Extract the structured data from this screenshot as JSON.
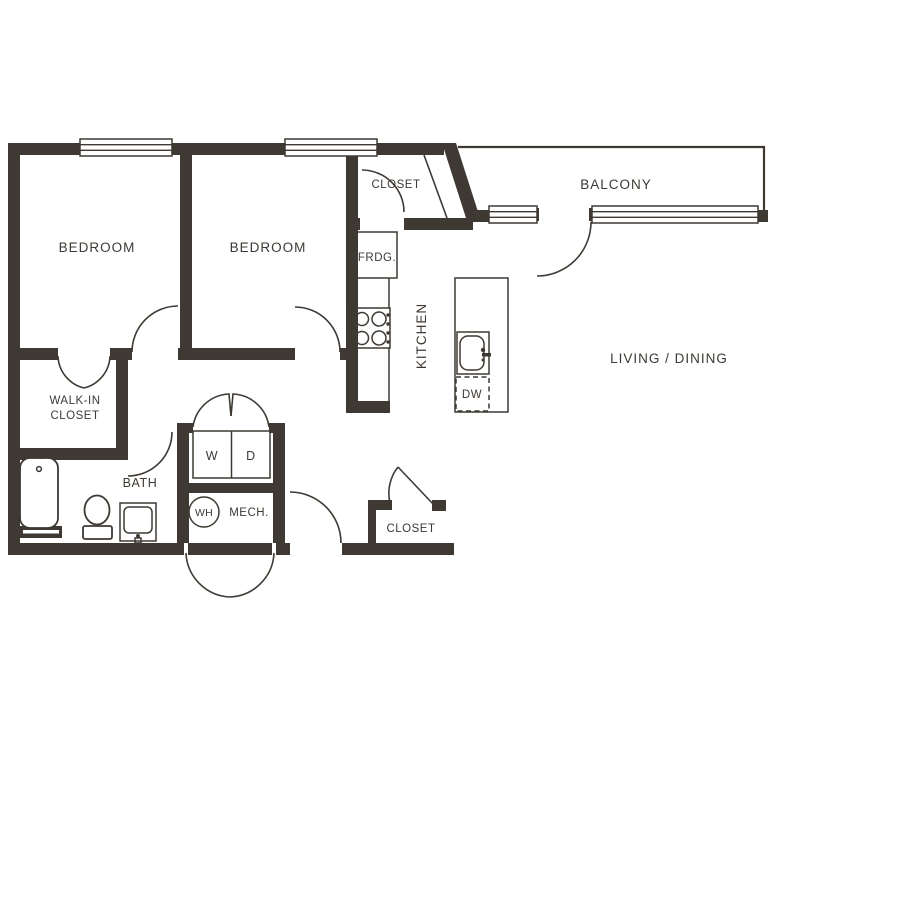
{
  "plan": {
    "labels": {
      "bedroom": "BEDROOM",
      "closet": "CLOSET",
      "balcony": "BALCONY",
      "fridge": "FRDG.",
      "kitchen": "KITCHEN",
      "living_dining": "LIVING / DINING",
      "walk_in_line1": "WALK-IN",
      "walk_in_line2": "CLOSET",
      "bath": "BATH",
      "washer": "W",
      "dryer": "D",
      "water_heater": "WH",
      "mech": "MECH.",
      "dishwasher": "DW"
    },
    "colors": {
      "wall": "#3E3933",
      "background": "#FFFFFF"
    }
  }
}
